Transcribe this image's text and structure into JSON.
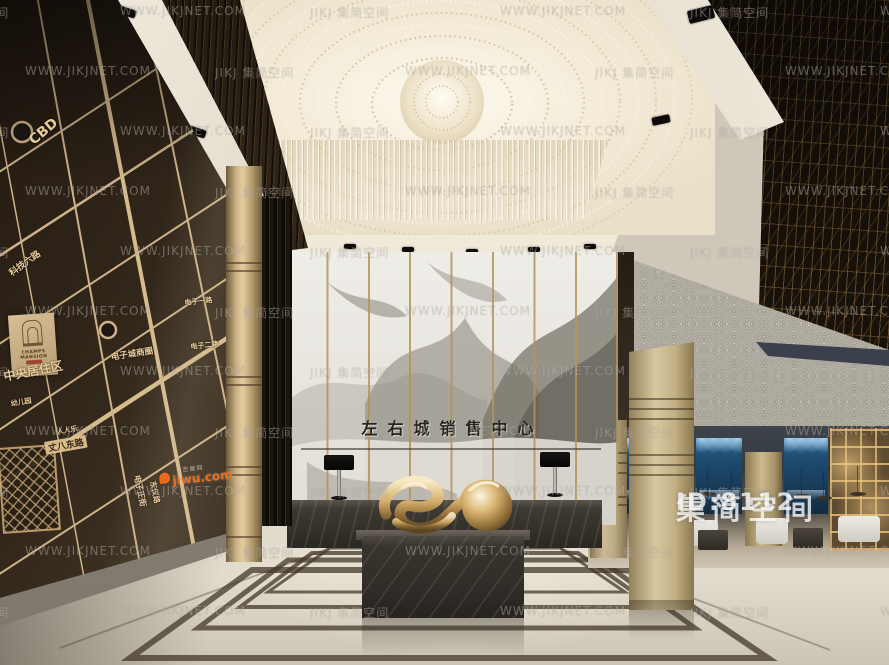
{
  "colors": {
    "gold_accent": "#d7b886",
    "marble_wall": "#e9e7e2",
    "dark_wood": "#2b2117",
    "jiwu_orange": "#ef6c1a",
    "restaurant_blue": "#1d4a6e"
  },
  "watermark": {
    "site": "WWW.JIKJNET.COM",
    "brand": "JIKJ 集简空间",
    "badge_brand": "集简空间",
    "badge_id": "ID:8112"
  },
  "jiwu": {
    "name": "jiwu.com",
    "label": "吉屋网"
  },
  "signage": {
    "hall_title": "左右城销售中心"
  },
  "map_wall": {
    "plaque_en": "CHAMPS MANSION",
    "labels": [
      {
        "text": "CBD",
        "x": 26,
        "y": 136,
        "rot": -40,
        "size": 14
      },
      {
        "text": "科技六路",
        "x": 6,
        "y": 268,
        "rot": -36,
        "size": 9
      },
      {
        "text": "中央居住区",
        "x": 2,
        "y": 368,
        "rot": -11,
        "size": 12
      },
      {
        "text": "丈八东路",
        "x": 44,
        "y": 442,
        "rot": -10,
        "size": 9,
        "style": "onroad"
      },
      {
        "text": "电子城商圈",
        "x": 110,
        "y": 351,
        "rot": -9,
        "size": 8.5
      },
      {
        "text": "电子正街",
        "x": 142,
        "y": 474,
        "rot": 78,
        "size": 8
      },
      {
        "text": "东仪路",
        "x": 158,
        "y": 480,
        "rot": 78,
        "size": 7.5
      },
      {
        "text": "人人乐",
        "x": 56,
        "y": 427,
        "rot": -9,
        "size": 7
      },
      {
        "text": "幼儿园",
        "x": 10,
        "y": 399,
        "rot": -9,
        "size": 7
      },
      {
        "text": "电子一路",
        "x": 184,
        "y": 298,
        "rot": -6,
        "size": 7
      },
      {
        "text": "电子二路",
        "x": 190,
        "y": 342,
        "rot": -6,
        "size": 7
      }
    ]
  }
}
